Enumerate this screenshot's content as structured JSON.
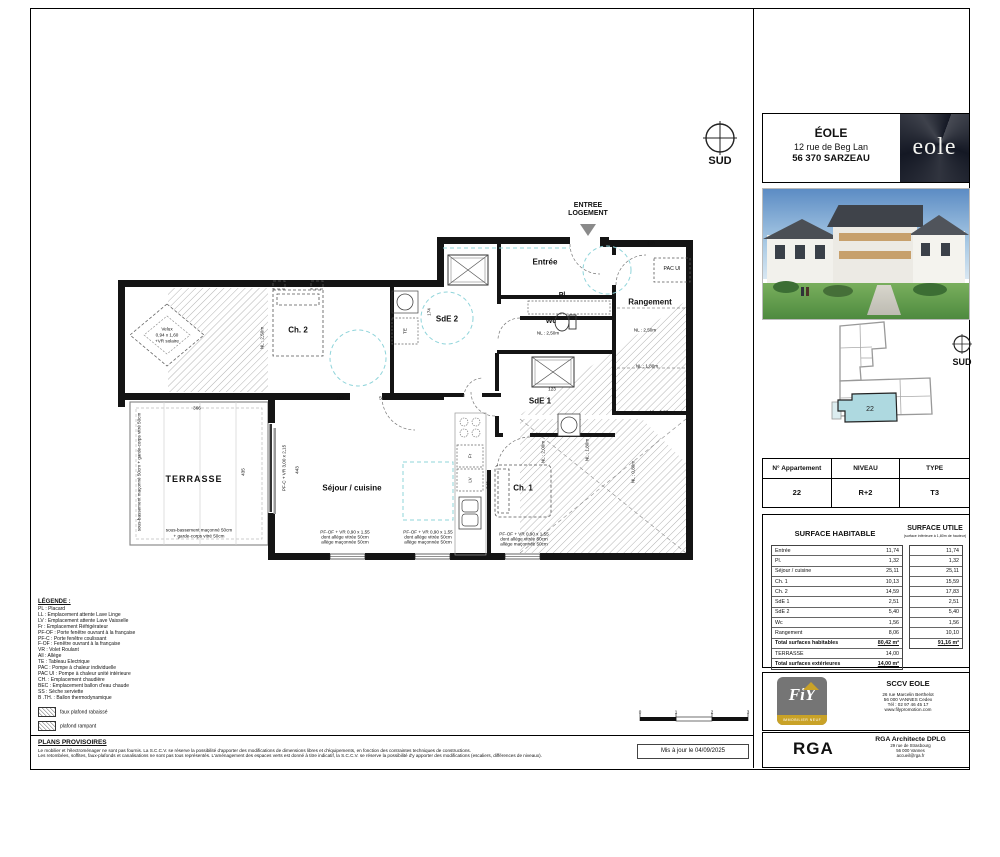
{
  "title_block": {
    "project": "ÉOLE",
    "address_line1": "12 rue de Beg Lan",
    "address_line2": "56 370 SARZEAU",
    "logo_text": "eole"
  },
  "compass": {
    "label": "SUD"
  },
  "site_plan": {
    "unit": "22",
    "compass_label": "SUD"
  },
  "entry": {
    "line1": "ENTREE",
    "line2": "LOGEMENT"
  },
  "plan": {
    "rooms": {
      "entree": "Entrée",
      "placard": "Pl.",
      "wc": "Wc",
      "rangement": "Rangement",
      "sde1": "SdE 1",
      "sde2": "SdE 2",
      "ch1": "Ch. 1",
      "ch2": "Ch. 2",
      "sejour": "Séjour / cuisine",
      "terrasse": "TERRASSE"
    },
    "fixtures": {
      "pac_ui": "PAC UI",
      "te": "TE",
      "fridge": "Fr",
      "dishwasher": "LV"
    },
    "annotations": {
      "velux_l1": "Velux",
      "velux_l2": "0,94 x 1,60",
      "velux_l3": "+VR solaire",
      "nl_250": "NL : 2,50m",
      "nl_200": "NL : 2,00m",
      "nl_180": "NL : 1,80m",
      "nl_080": "NL : 0,80m",
      "pfc": "PF-C + VR 3,00 x 2,15",
      "window_l1": "PF-OF + VR 0,90 x 1,55",
      "window_l2": "dont allège vitrée 50cm",
      "window_l3": "allège maçonnée 50cm",
      "terrasse_side": "sous-bassement maçonné 50cm + garde-corps vitré 50cm",
      "terrasse_bottom_l1": "sous-bassement maçonné 50cm",
      "terrasse_bottom_l2": "+ garde-corps vitré 50cm"
    },
    "dims": {
      "d228": "228",
      "d595": "595",
      "d366": "366",
      "d435": "435",
      "d443": "443",
      "d343": "343",
      "d174": "174",
      "d123": "123",
      "d160": "160"
    },
    "scale": {
      "t0": "0",
      "t1": "1",
      "t2": "2",
      "t3": "3"
    }
  },
  "apartment_table": {
    "headers": [
      "N° Appartement",
      "NIVEAU",
      "TYPE"
    ],
    "values": [
      "22",
      "R+2",
      "T3"
    ]
  },
  "surfaces": {
    "habitable_title": "SURFACE HABITABLE",
    "utile_title": "SURFACE UTILE",
    "utile_subtitle": "(surface inférieure à 1,80m de hauteur)",
    "rows": [
      {
        "label": "Entrée",
        "hab": "11,74",
        "utile": "11,74"
      },
      {
        "label": "Pl.",
        "hab": "1,32",
        "utile": "1,32"
      },
      {
        "label": "Séjour / cuisine",
        "hab": "25,11",
        "utile": "25,11"
      },
      {
        "label": "Ch. 1",
        "hab": "10,13",
        "utile": "15,59"
      },
      {
        "label": "Ch. 2",
        "hab": "14,59",
        "utile": "17,83"
      },
      {
        "label": "SdE 1",
        "hab": "2,51",
        "utile": "2,51"
      },
      {
        "label": "SdE 2",
        "hab": "5,40",
        "utile": "5,40"
      },
      {
        "label": "Wc",
        "hab": "1,56",
        "utile": "1,56"
      },
      {
        "label": "Rangement",
        "hab": "8,06",
        "utile": "10,10"
      }
    ],
    "total_hab_label": "Total surfaces habitables",
    "total_hab": "80,42 m²",
    "terrasse_label": "TERRASSE",
    "terrasse_value": "14,00",
    "total_ext_label": "Total surfaces extérieures",
    "total_ext": "14,00 m²",
    "total_utile": "91,16 m²"
  },
  "legend": {
    "title": "LÉGENDE :",
    "items": [
      "PL : Placard",
      "LL : Emplacement attente Lave Linge",
      "LV : Emplacement attente Lave Vaisselle",
      "Fr : Emplacement Réfrigérateur",
      "PF-OF : Porte fenêtre ouvrant à la française",
      "PF-C : Porte fenêtre coulissant",
      "F-OF : Fenêtre ouvrant à la française",
      "VR : Volet Roulant",
      "All : Allège",
      "TE : Tableau Electrique",
      "PAC : Pompe à chaleur individuelle",
      "PAC UI : Pompe à chaleur unité intérieure",
      "CH. : Emplacement chaudière",
      "BEC : Emplacement ballon d'eau chaude",
      "SS : Sèche serviette",
      "B .TH. : Ballon thermodynamique"
    ],
    "swatch1": "faux plafond rabaissé",
    "swatch2": "plafond rampant"
  },
  "disclaimer": {
    "title": "PLANS PROVISOIRES",
    "line1": "Le mobilier et l'électroménager ne sont pas fournis. La S.C.C.V. se réserve la possibilité d'apporter des modifications de dimensions libres et d'équipements, en fonction des contraintes techniques de constructions.",
    "line2": "Les retombées, soffites, faux-plafonds et canalisations ne sont pas tous représentés. L'aménagement des espaces verts est donné à titre indicatif, la S.C.C.V. se réserve la possibilité d'y apporter des modifications (escaliers, différences de niveaux)."
  },
  "updated": "Mis à jour le 04/09/2025",
  "promoter": {
    "logo": "FiY",
    "logo_sub": "IMMOBILIER NEUF",
    "name": "SCCV EOLE",
    "addr1": "26 rue Marcelin Berthelot",
    "addr2": "56 000 VANNES Cedex",
    "addr3": "Tél : 02 97 46 45 17",
    "addr4": "www.filypromotion.com"
  },
  "architect": {
    "logo": "RGA",
    "name": "RGA Architecte DPLG",
    "addr1": "29 rue de Strasbourg",
    "addr2": "56 000 Vannes",
    "addr3": "accueil@rga.fr"
  },
  "colors": {
    "highlight": "#aed9e0",
    "logo_bg": "#141824",
    "turning_circle": "#8fd4da",
    "hatch": "#adadad"
  }
}
